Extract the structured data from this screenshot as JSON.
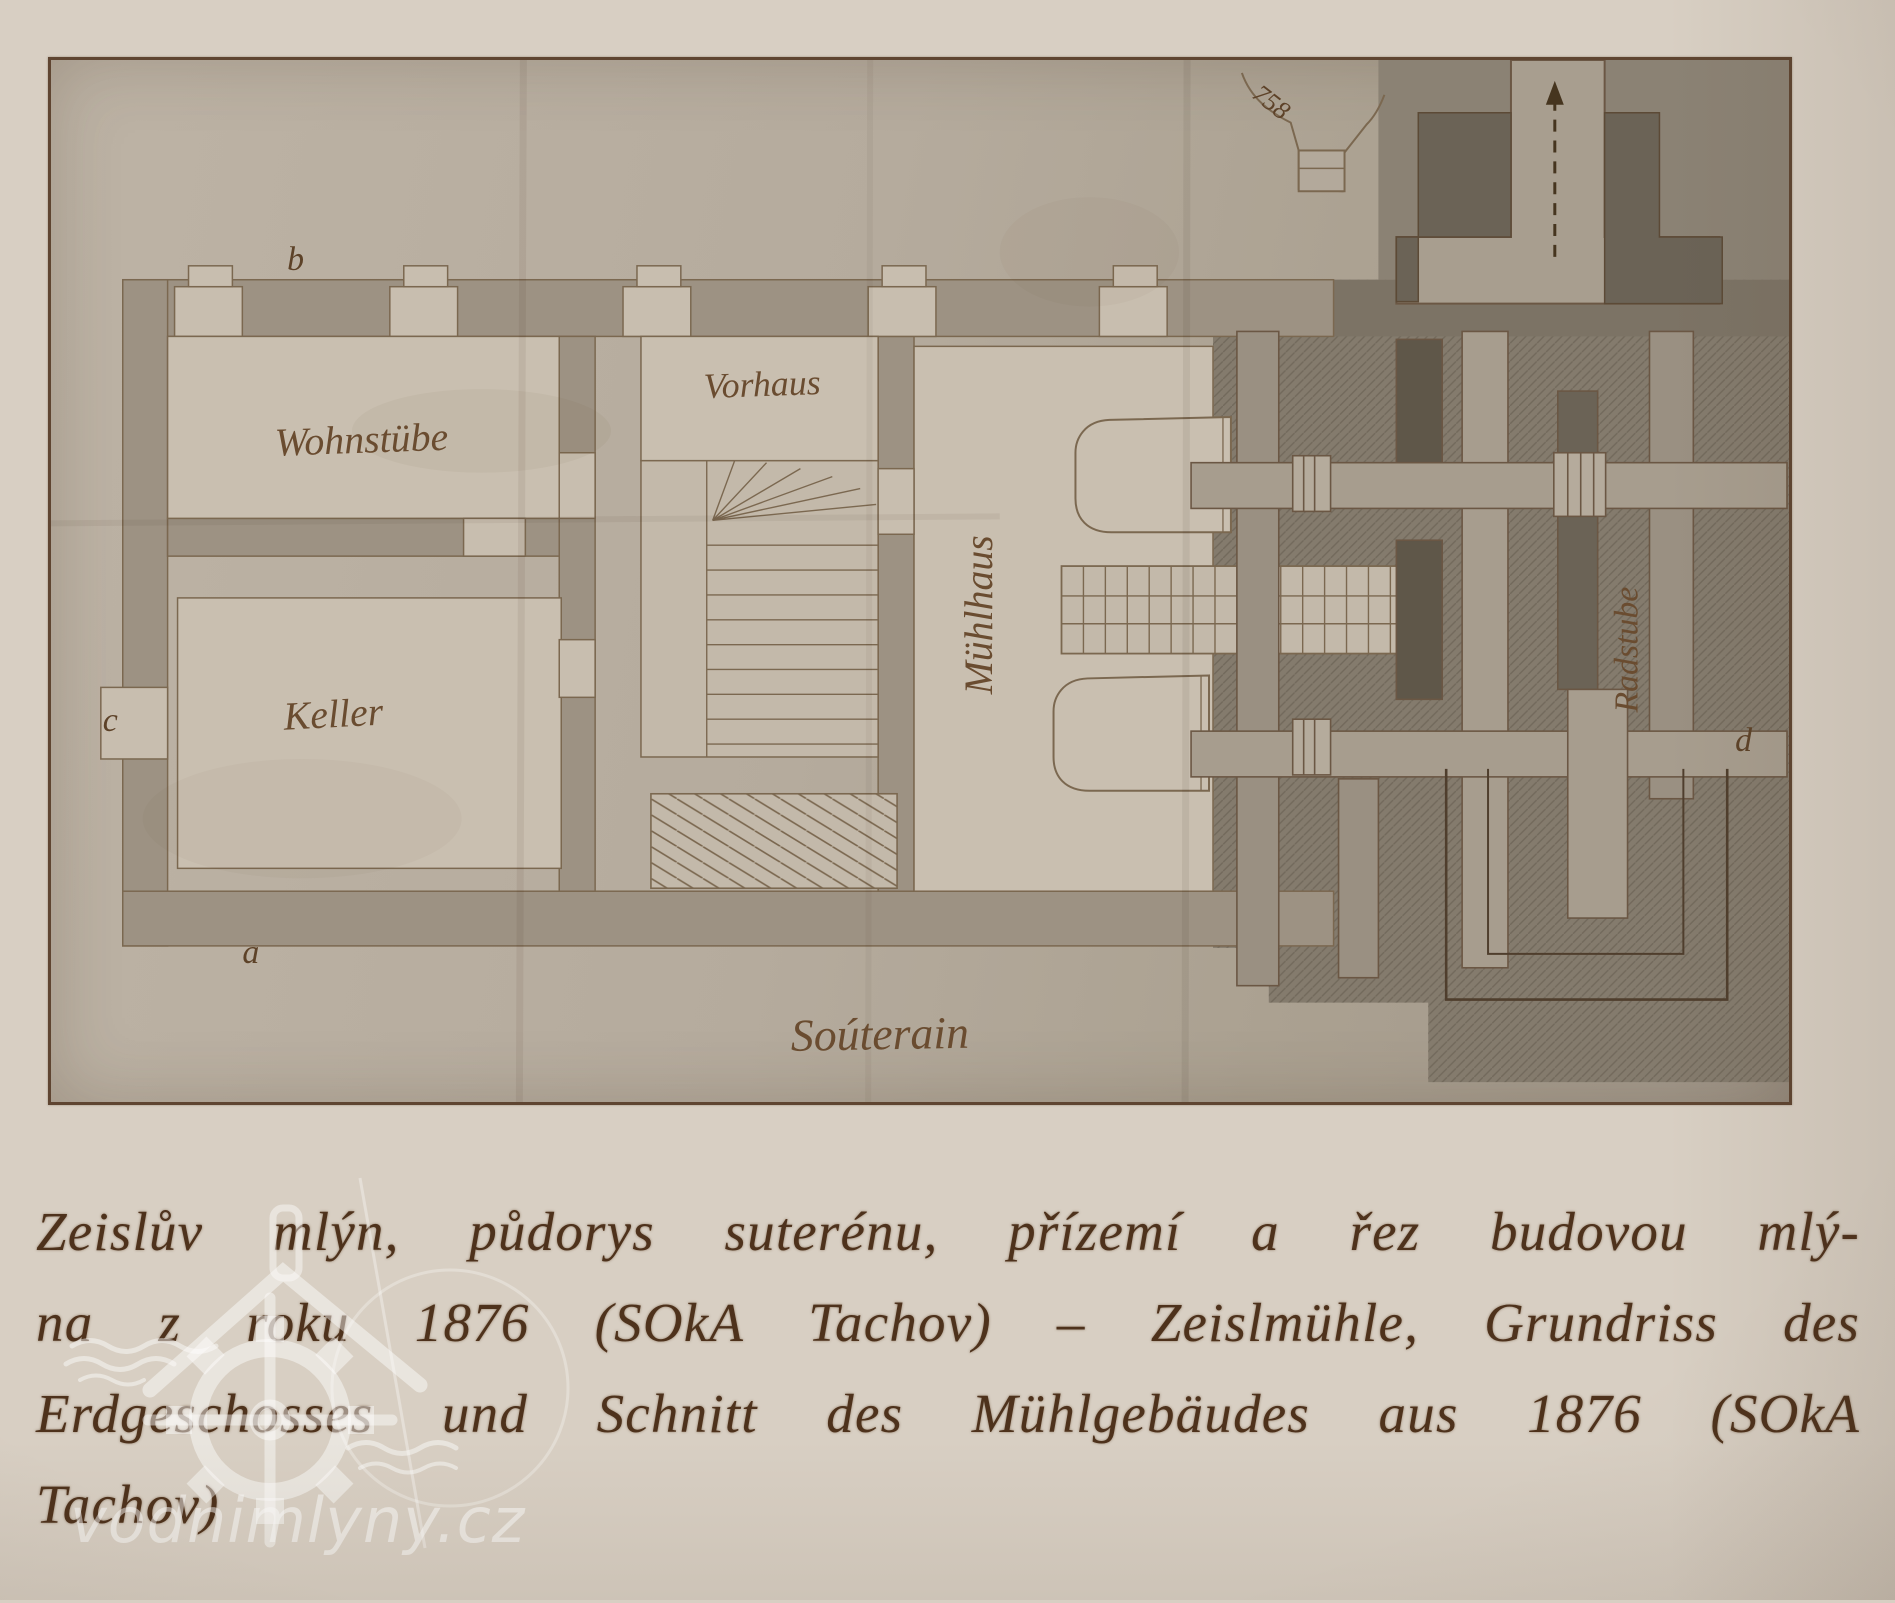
{
  "plan": {
    "rooms": {
      "wohnstube": "Wohnstübe",
      "vorhaus": "Vorhaus",
      "keller": "Keller",
      "muehlhaus": "Mühlhaus",
      "radstube": "Radstube",
      "souterrain": "Soúterain"
    },
    "markers": {
      "a": "a",
      "b": "b",
      "c": "c",
      "d": "d",
      "number": "758"
    }
  },
  "caption": {
    "lines": [
      "Zeislův mlýn, půdorys suterénu, přízemí a řez budovou mlý-",
      "na z roku 1876 (SOkA Tachov) – Zeislmühle, Grundriss des",
      "Erdgeschosses und Schnitt des Mühlgebäudes aus 1876 (SOkA",
      "Tachov)"
    ]
  },
  "watermark": {
    "text": "vodnimlyny.cz"
  },
  "colors": {
    "page_background": "#d8cfc3",
    "plan_paper": "#b5ab9d",
    "room_fill": "#c9bfb0",
    "wall_fill": "#9d9283",
    "dark_area": "#847b6d",
    "ink_line": "#7b6850",
    "caption_ink": "#4e321c",
    "frame_border": "#5f4531"
  }
}
